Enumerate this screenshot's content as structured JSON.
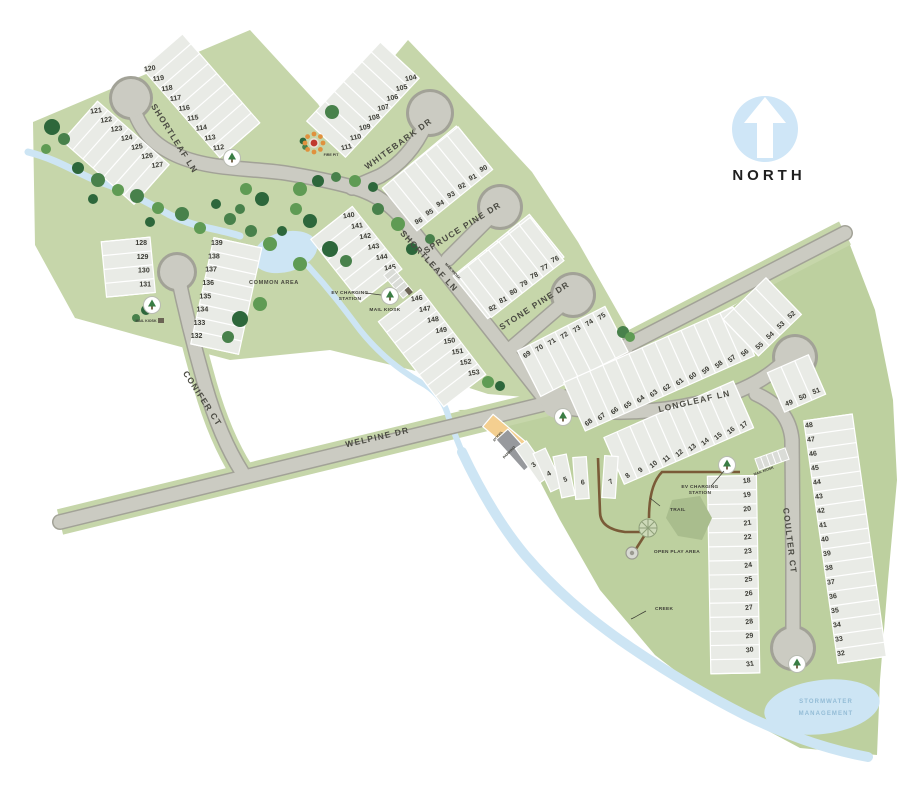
{
  "streets": [
    {
      "name": "shortleaf-ln",
      "label": "SHORTLEAF LN"
    },
    {
      "name": "whitebark-dr",
      "label": "WHITEBARK DR"
    },
    {
      "name": "spruce-pine-dr",
      "label": "SPRUCE PINE DR"
    },
    {
      "name": "stone-pine-dr",
      "label": "STONE PINE DR"
    },
    {
      "name": "conifer-ct",
      "label": "CONIFER CT"
    },
    {
      "name": "welpine-dr",
      "label": "WELPINE DR"
    },
    {
      "name": "longleaf-ln",
      "label": "LONGLEAF LN"
    },
    {
      "name": "coulter-ct",
      "label": "COULTER CT"
    }
  ],
  "labels": {
    "north": "NORTH",
    "common_area": "COMMON AREA",
    "fire_pit": "FIRE PIT",
    "ev_charging_line1": "EV CHARGING",
    "ev_charging_line2": "STATION",
    "mail_kiosk": "MAIL KIOSK",
    "trail": "TRAIL",
    "open_play_area": "OPEN PLAY AREA",
    "creek": "CREEK",
    "stormwater_line1": "STORMWATER",
    "stormwater_line2": "MANAGEMENT",
    "model": "MODEL",
    "parking": "PARKING"
  },
  "lot_rows": {
    "a1": [
      "120",
      "119",
      "118",
      "117",
      "116",
      "115",
      "114",
      "113",
      "112"
    ],
    "a2": [
      "121",
      "122",
      "123",
      "124",
      "125",
      "126",
      "127"
    ],
    "b1": [
      "111",
      "110",
      "109",
      "108",
      "107",
      "106",
      "105",
      "104"
    ],
    "b2": [
      "97",
      "98",
      "99",
      "100",
      "101",
      "102",
      "103"
    ],
    "b3": [
      "96",
      "95",
      "94",
      "93",
      "92",
      "91",
      "90"
    ],
    "c1": [
      "83",
      "84",
      "85",
      "86",
      "87",
      "88",
      "89"
    ],
    "c2": [
      "82",
      "81",
      "80",
      "79",
      "78",
      "77",
      "76"
    ],
    "d1": [
      "69",
      "70",
      "71",
      "72",
      "73",
      "74",
      "75"
    ],
    "e1": [
      "140",
      "141",
      "142",
      "143",
      "144",
      "145"
    ],
    "e2": [
      "146",
      "147",
      "148",
      "149",
      "150",
      "151",
      "152",
      "153"
    ],
    "g1": [
      "128",
      "129",
      "130",
      "131"
    ],
    "g2": [
      "139",
      "138",
      "137",
      "136",
      "135",
      "134",
      "133",
      "132"
    ],
    "h1": [
      "68",
      "67",
      "66",
      "65",
      "64",
      "63",
      "62",
      "61",
      "60",
      "59",
      "58",
      "57",
      "56"
    ],
    "h2": [
      "55",
      "54",
      "53",
      "52"
    ],
    "i1": [
      "8",
      "9",
      "10",
      "11",
      "12",
      "13",
      "14",
      "15",
      "16",
      "17"
    ],
    "j": [
      "1",
      "2",
      "3",
      "4",
      "5",
      "6",
      "7"
    ],
    "k1": [
      "18",
      "19",
      "20",
      "21",
      "22",
      "23",
      "24",
      "25",
      "26",
      "27",
      "28",
      "29",
      "30",
      "31"
    ],
    "l1": [
      "48",
      "47",
      "46",
      "45",
      "44",
      "43",
      "42",
      "41",
      "40",
      "39",
      "38",
      "37",
      "36",
      "35",
      "34",
      "33",
      "32"
    ],
    "m1": [
      "49",
      "50",
      "51"
    ]
  },
  "colors": {
    "land": "#c6d6aa",
    "land_right": "#bdd09f",
    "lot_fill": "#e9ebe6",
    "lot_stroke": "#ffffff",
    "road_fill": "#cbcbc2",
    "road_casing": "#a2a297",
    "water": "#cde5f4",
    "tree_dark": "#2d673b",
    "tree_mid": "#48814b",
    "trail": "#7a5b38",
    "north_circle": "#cfe6f7",
    "model_fill": "#f4cf90",
    "parking_fill": "#97999d",
    "fire_orange": "#e0913d",
    "fire_red": "#bf3a2e",
    "mound": "#a9bd8d"
  }
}
